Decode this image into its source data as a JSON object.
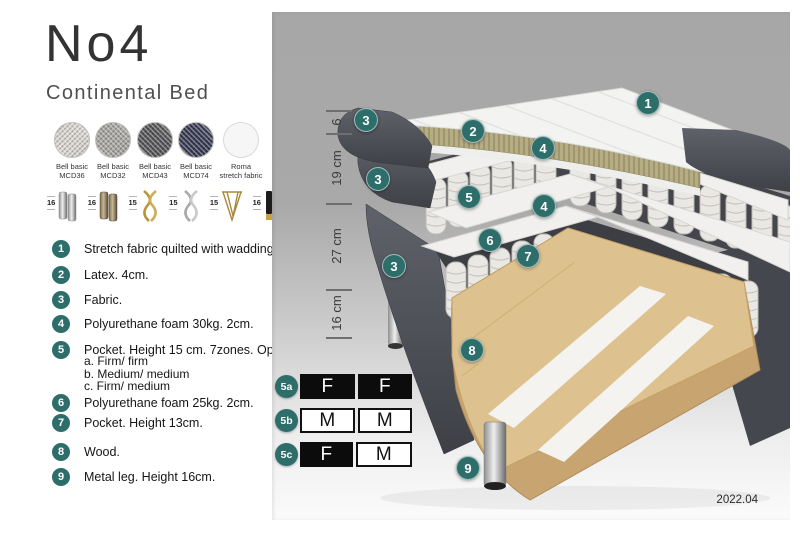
{
  "header": {
    "title": "No4",
    "subtitle": "Continental Bed"
  },
  "fabrics": [
    {
      "line1": "Bell basic",
      "line2": "MCD36",
      "color": "#dad7d2",
      "texture": "woven"
    },
    {
      "line1": "Bell basic",
      "line2": "MCD32",
      "color": "#a8a6a2",
      "texture": "woven"
    },
    {
      "line1": "Bell basic",
      "line2": "MCD43",
      "color": "#57575a",
      "texture": "woven"
    },
    {
      "line1": "Bell basic",
      "line2": "MCD74",
      "color": "#383c54",
      "texture": "woven"
    },
    {
      "line1": "Roma",
      "line2": "stretch fabric",
      "color": "#f6f6f6",
      "texture": "plain"
    }
  ],
  "legs": [
    {
      "size": "16",
      "type": "chrome-cylinder-leg"
    },
    {
      "size": "16",
      "type": "bronze-cylinder-leg"
    },
    {
      "size": "15",
      "type": "gold-twist-leg"
    },
    {
      "size": "15",
      "type": "silver-twist-leg"
    },
    {
      "size": "15",
      "type": "gold-hairpin-leg"
    },
    {
      "size": "16",
      "type": "black-gold-leg"
    }
  ],
  "spec_list": [
    {
      "num": "1",
      "text": "Stretch fabric quilted with wadding."
    },
    {
      "num": "2",
      "text": "Latex. 4cm."
    },
    {
      "num": "3",
      "text": "Fabric."
    },
    {
      "num": "4",
      "text": "Polyurethane foam 30kg. 2cm."
    },
    {
      "num": "5",
      "text": "Pocket. Height 15 cm. 7zones. Option:",
      "options": [
        "a. Firm/ firm",
        "b. Medium/ medium",
        "c. Firm/ medium"
      ]
    },
    {
      "num": "6",
      "text": "Polyurethane foam 25kg. 2cm."
    },
    {
      "num": "7",
      "text": "Pocket. Height 13cm."
    },
    {
      "num": "8",
      "text": "Wood."
    },
    {
      "num": "9",
      "text": "Metal leg. Height 16cm."
    }
  ],
  "bed": {
    "measurements": [
      {
        "label": "6"
      },
      {
        "label": "19 cm"
      },
      {
        "label": "27 cm"
      },
      {
        "label": "16 cm"
      }
    ],
    "callouts": [
      {
        "label": "1"
      },
      {
        "label": "2"
      },
      {
        "label": "3"
      },
      {
        "label": "4"
      },
      {
        "label": "3"
      },
      {
        "label": "5"
      },
      {
        "label": "4"
      },
      {
        "label": "6"
      },
      {
        "label": "7"
      },
      {
        "label": "3"
      },
      {
        "label": "8"
      },
      {
        "label": "9"
      }
    ]
  },
  "firmness": {
    "rows": [
      {
        "id": "5a",
        "cells": [
          {
            "label": "F",
            "tone": "dark"
          },
          {
            "label": "F",
            "tone": "dark"
          }
        ]
      },
      {
        "id": "5b",
        "cells": [
          {
            "label": "M",
            "tone": "light"
          },
          {
            "label": "M",
            "tone": "light"
          }
        ]
      },
      {
        "id": "5c",
        "cells": [
          {
            "label": "F",
            "tone": "dark"
          },
          {
            "label": "M",
            "tone": "light"
          }
        ]
      }
    ]
  },
  "version": "2022.04",
  "colors": {
    "accent_teal": "#2e6e6a",
    "dark_fabric": "#4d4f56",
    "latex": "#b6ad84",
    "wood": "#ddc28f"
  }
}
